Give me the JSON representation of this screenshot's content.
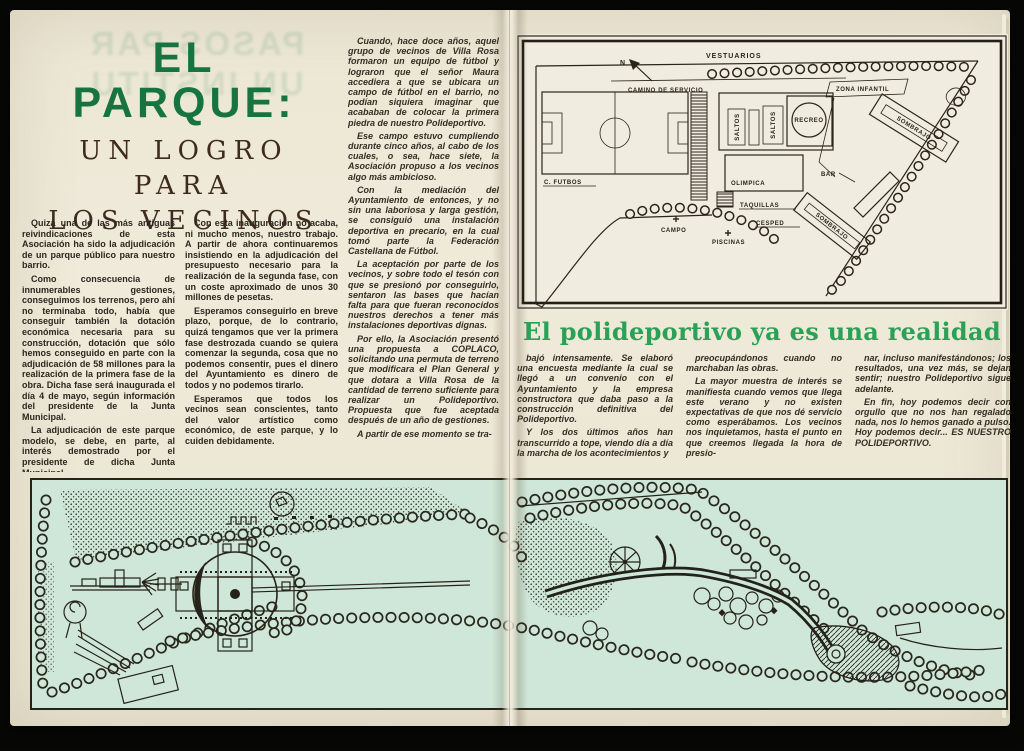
{
  "colors": {
    "title_green": "#17743f",
    "headline_green": "#2aa156",
    "paper_cream": "#ece7d5",
    "plan_paper": "#f0ece0",
    "park_mint": "#cfe7d8",
    "ink": "#2b241c"
  },
  "left_page": {
    "ghost": {
      "line1": "PASOS PAR",
      "line2": "UN INSTITU"
    },
    "title": {
      "l1": "EL",
      "l2": "PARQUE:",
      "s1": "UN LOGRO",
      "s2": "PARA",
      "s3": "LOS VECINOS"
    },
    "col1": [
      "Quizá una de las más antiguas reivindicaciones de esta Asociación ha sido la adjudicación de un parque público para nuestro barrio.",
      "Como consecuencia de innumerables gestiones, conseguimos los terrenos, pero ahí no terminaba todo, había que conseguir también la dotación económica necesaria para su construcción, dotación que sólo hemos conseguido en parte con la adjudicación de 58 millones para la realización de la primera fase de la obra. Dicha fase será inaugurada el día 4 de mayo, según información del presidente de la Junta Municipal.",
      "La adjudicación de este parque modelo, se debe, en parte, al interés demostrado por el presidente de dicha Junta Municipal."
    ],
    "col2": [
      "Con esta inauguración no acaba, ni mucho menos, nuestro trabajo. A partir de ahora continuaremos insistiendo en la adjudicación del presupuesto necesario para la realización de la segunda fase, con un coste aproximado de unos 30 millones de pesetas.",
      "Esperamos conseguirlo en breve plazo, porque, de lo contrario, quizá tengamos que ver la primera fase destrozada cuando se quiera comenzar la segunda, cosa que no podemos consentir, pues el dinero del Ayuntamiento es dinero de todos y no podemos tirarlo.",
      "Esperamos que todos los vecinos sean conscientes, tanto del valor artístico como económico, de este parque, y lo cuiden debidamente."
    ],
    "col3": [
      "Cuando, hace doce años, aquel grupo de vecinos de Villa Rosa formaron un equipo de fútbol y lograron que el señor Maura accediera a que se ubicara un campo de fútbol en el barrio, no podían siquiera imaginar que acababan de colocar la primera piedra de nuestro Polideportivo.",
      "Ese campo estuvo cumpliendo durante cinco años, al cabo de los cuales, o sea, hace siete, la Asociación propuso a los vecinos algo más ambicioso.",
      "Con la mediación del Ayuntamiento de entonces, y no sin una laboriosa y larga gestión, se consiguió una instalación deportiva en precario, en la cual tomó parte la Federación Castellana de Fútbol.",
      "La aceptación por parte de los vecinos, y sobre todo el tesón con que se presionó por conseguirlo, sentaron las bases que hacían falta para que fueran reconocidos nuestros derechos a tener más instalaciones deportivas dignas.",
      "Por ello, la Asociación presentó una propuesta a COPLACO, solicitando una permuta de terreno que modificara el Plan General y que dotara a Villa Rosa de la cantidad de terreno suficiente para realizar un Polideportivo. Propuesta que fue aceptada después de un año de gestiones.",
      "A partir de ese momento se tra-"
    ]
  },
  "right_page": {
    "headline": "El polideportivo ya es una realidad",
    "col1": [
      "bajó intensamente. Se elaboró una encuesta mediante la cual se llegó a un convenio con el Ayuntamiento y la empresa constructora que daba paso a la construcción definitiva del Polideportivo.",
      "Y los dos últimos años han transcurrido a tope, viendo día a día la marcha de los acontecimientos y"
    ],
    "col2": [
      "preocupándonos cuando no marchaban las obras.",
      "La mayor muestra de interés se manifiesta cuando vemos que llega este verano y no existen expectativas de que nos dé servicio como esperábamos. Los vecinos nos inquietamos, hasta el punto en que creemos llegada la hora de presio-"
    ],
    "col3": [
      "nar, incluso manifestándonos; los resultados, una vez más, se dejan sentir; nuestro Polideportivo sigue adelante.",
      "En fin, hoy podemos decir con orgullo que no nos han regalado nada, nos lo hemos ganado a pulso. Hoy podemos decir... ES NUESTRO POLIDEPORTIVO."
    ],
    "site_plan": {
      "north": "N",
      "vestuarios": "VESTUARIOS",
      "camino": "CAMINO DE SERVICIO",
      "zona_infantil": "ZONA INFANTIL",
      "saltos_a": "SALTOS",
      "saltos_b": "SALTOS",
      "recreo": "RECREO",
      "olimpica": "OLIMPICA",
      "campo_futbol": "C. FUTBOS",
      "taquillas": "TAQUILLAS",
      "cesped": "CESPED",
      "bar": "BAR",
      "sombrajo_a": "SOMBRAJO",
      "sombrajo_b": "SOMBRAJO",
      "campo": "CAMPO",
      "piscinas": "PISCINAS"
    }
  }
}
